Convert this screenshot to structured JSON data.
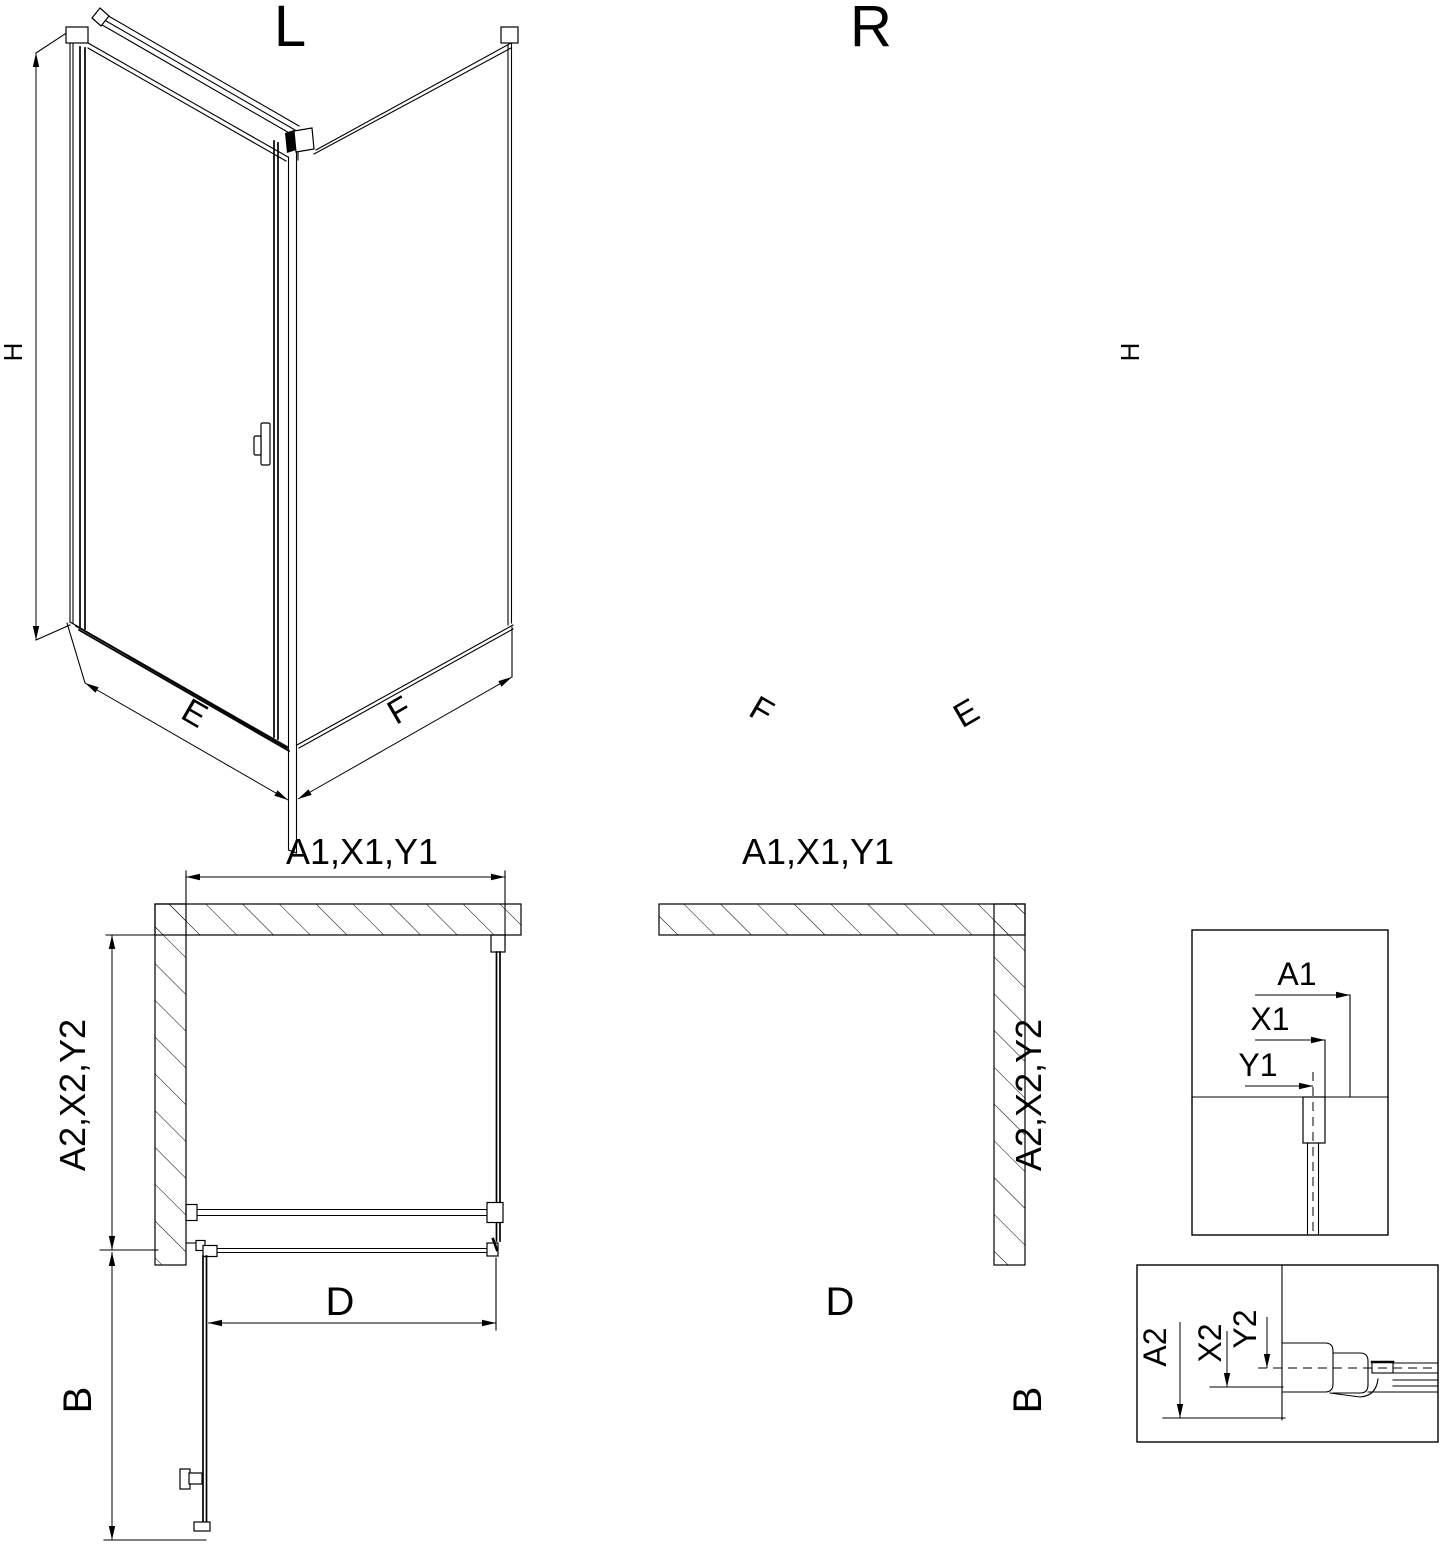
{
  "drawing": {
    "iso_left": {
      "title": "L",
      "height_label": "H",
      "door_side_label": "E",
      "panel_side_label": "F"
    },
    "iso_right": {
      "title": "R",
      "height_label": "H",
      "door_side_label": "E",
      "panel_side_label": "F"
    },
    "plan_left": {
      "width_label": "A1,X1,Y1",
      "depth_label": "A2,X2,Y2",
      "door_width_label": "D",
      "door_swing_label": "B"
    },
    "plan_right": {
      "width_label": "A1,X1,Y1",
      "depth_label": "A2,X2,Y2",
      "door_width_label": "D",
      "door_swing_label": "B"
    },
    "detail_width": {
      "a1": "A1",
      "x1": "X1",
      "y1": "Y1"
    },
    "detail_depth": {
      "a2": "A2",
      "x2": "X2",
      "y2": "Y2"
    }
  },
  "colors": {
    "line": "#000000",
    "background": "#ffffff"
  }
}
